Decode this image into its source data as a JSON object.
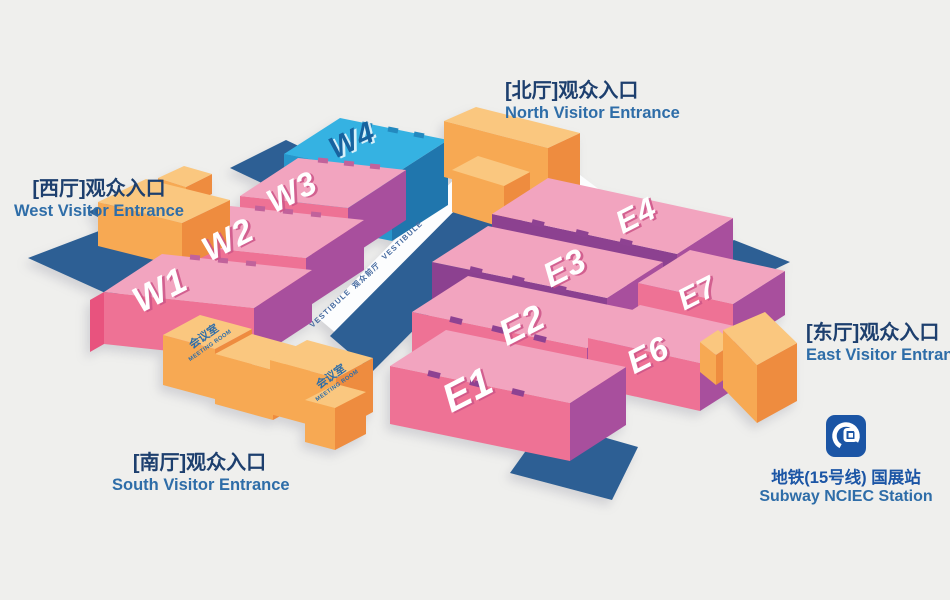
{
  "halls": {
    "w1": "W1",
    "w2": "W2",
    "w3": "W3",
    "w4": "W4",
    "e1": "E1",
    "e2": "E2",
    "e3": "E3",
    "e4": "E4",
    "e6": "E6",
    "e7": "E7"
  },
  "entrances": {
    "north": {
      "zh": "[北厅]观众入口",
      "en": "North Visitor Entrance"
    },
    "west": {
      "zh": "[西厅]观众入口",
      "en": "West Visitor Entrance"
    },
    "south": {
      "zh": "[南厅]观众入口",
      "en": "South Visitor Entrance"
    },
    "east": {
      "zh": "[东厅]观众入口",
      "en": "East Visitor Entrance"
    }
  },
  "subway": {
    "zh": "地铁(15号线) 国展站",
    "en": "Subway NCIEC Station"
  },
  "vestibule": {
    "en": "VESTIBULE",
    "zh": "观众前厅"
  },
  "meeting_room": {
    "zh": "会议室",
    "en": "MEETING ROOM"
  },
  "colors": {
    "background": "#efefed",
    "plaza_navy": "#2d5f94",
    "hall_pink_top": "#f2a4bf",
    "hall_pink_front": "#ee7295",
    "hall_pink_side": "#a84f9d",
    "hall_cyan_top": "#35b2e2",
    "hall_cyan_front": "#2796cb",
    "hall_cyan_side": "#2076ad",
    "building_orange_top": "#fac77f",
    "building_orange_front": "#f7a953",
    "building_orange_side": "#ee8c3f",
    "vestibule_white": "#fcfdfe",
    "text_zh": "#1d3f6e",
    "text_en": "#2e6da8",
    "subway_blue": "#1b55a5"
  }
}
